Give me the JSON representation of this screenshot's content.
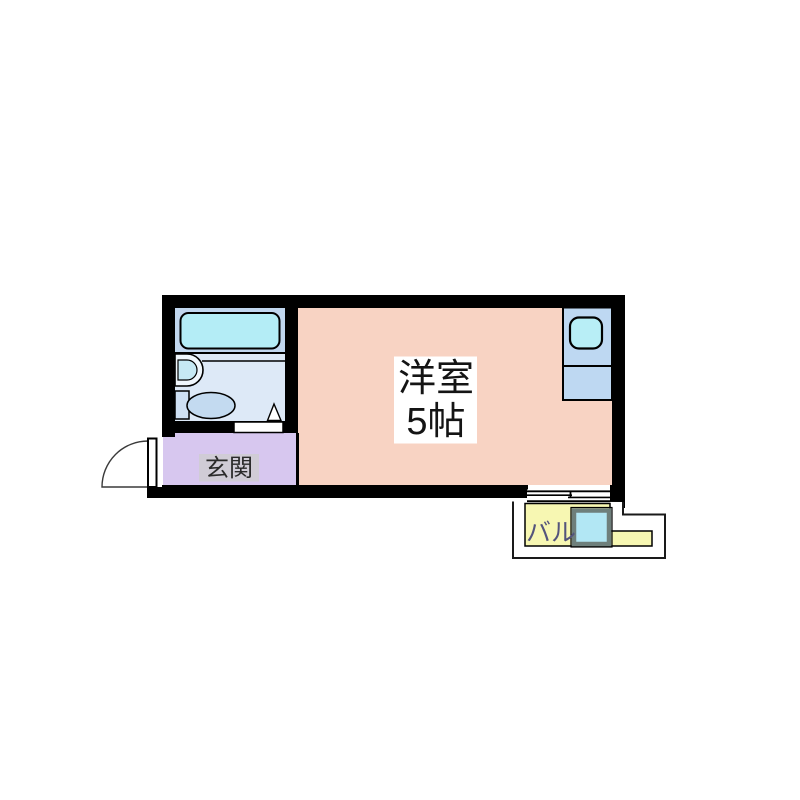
{
  "floorplan": {
    "western_room": {
      "label": "洋室",
      "size_label": "5帖",
      "floor_color": "#f8d3c3",
      "label_bg": "#ffffff",
      "label_color": "#141414"
    },
    "entrance": {
      "label": "玄関",
      "floor_color": "#d7c7ef",
      "label_bg": "#d0ccd6",
      "label_color": "#2a2a2a"
    },
    "balcony": {
      "label": "バル",
      "floor_color": "#f7f7b2",
      "label_color": "#54547c",
      "deck_color": "#ffffff"
    },
    "bathroom": {
      "floor_upper_color": "#c1d7ef",
      "floor_lower_color": "#dde9f7"
    },
    "fixtures": {
      "bathtub_color": "#b4edf6",
      "washbasin_color": "#c6e9f4",
      "washbasin_rim_color": "#f0f7fd",
      "toilet_color": "#c3daf0",
      "toilet_tank_color": "#cfe0f3",
      "kitchen_unit_color": "#bed8f2",
      "kitchen_sink_color": "#b8eef6",
      "washer_pan_color": "#b2e7f4",
      "washer_pan_border_color": "#6e7f7b",
      "door_leaf_color": "#ffffff"
    },
    "wall_color": "#000000",
    "background_color": "#ffffff"
  }
}
